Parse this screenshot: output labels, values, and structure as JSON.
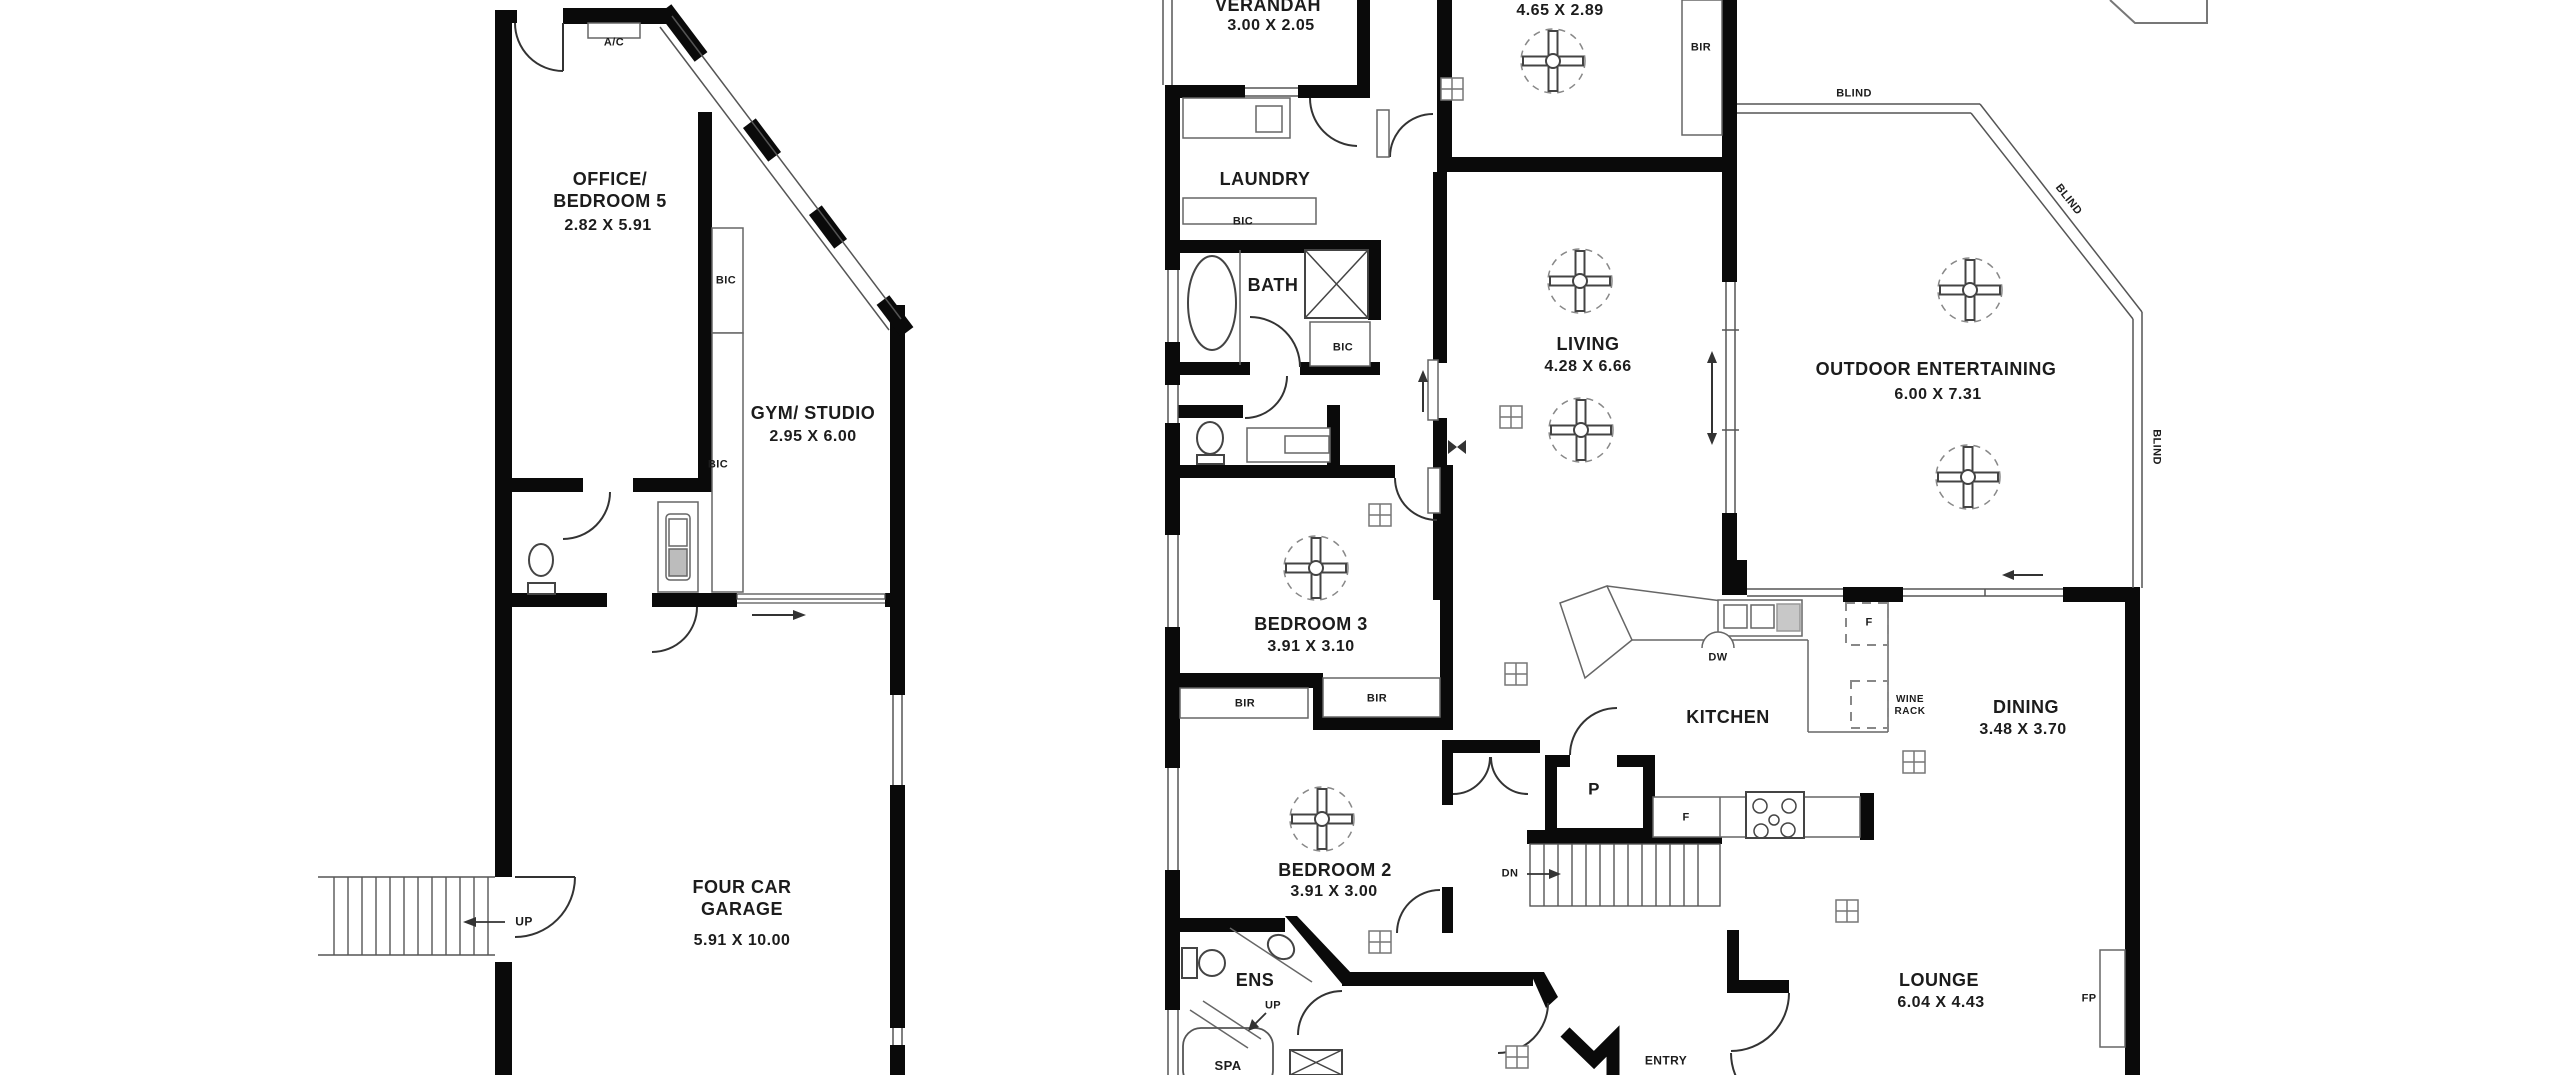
{
  "floorplan": {
    "background_color": "#ffffff",
    "wall_color": "#0a0a0a",
    "rooms": [
      {
        "name": "OFFICE/\nBEDROOM 5",
        "dims": "2.82 X 5.91"
      },
      {
        "name": "GYM/ STUDIO",
        "dims": "2.95 X 6.00"
      },
      {
        "name": "FOUR CAR\nGARAGE",
        "dims": "5.91 X 10.00"
      },
      {
        "name": "VERANDAH",
        "dims": "3.00 X 2.05"
      },
      {
        "name": "LAUNDRY",
        "dims": ""
      },
      {
        "name": "BATH",
        "dims": ""
      },
      {
        "name": "",
        "dims": "4.65 X 2.89"
      },
      {
        "name": "LIVING",
        "dims": "4.28 X 6.66"
      },
      {
        "name": "OUTDOOR ENTERTAINING",
        "dims": "6.00 X 7.31"
      },
      {
        "name": "BEDROOM 3",
        "dims": "3.91 X 3.10"
      },
      {
        "name": "KITCHEN",
        "dims": ""
      },
      {
        "name": "DINING",
        "dims": "3.48 X 3.70"
      },
      {
        "name": "BEDROOM 2",
        "dims": "3.91 X 3.00"
      },
      {
        "name": "ENS",
        "dims": ""
      },
      {
        "name": "SPA",
        "dims": ""
      },
      {
        "name": "LOUNGE",
        "dims": "6.04 X 4.43"
      },
      {
        "name": "ENTRY",
        "dims": ""
      }
    ],
    "annotations": {
      "ac": "A/C",
      "bic": "BIC",
      "bir": "BIR",
      "blind": "BLIND",
      "up": "UP",
      "dn": "DN",
      "dw": "DW",
      "fridge": "F",
      "pantry": "P",
      "fireplace": "FP",
      "wine_rack": "WINE\nRACK"
    }
  }
}
